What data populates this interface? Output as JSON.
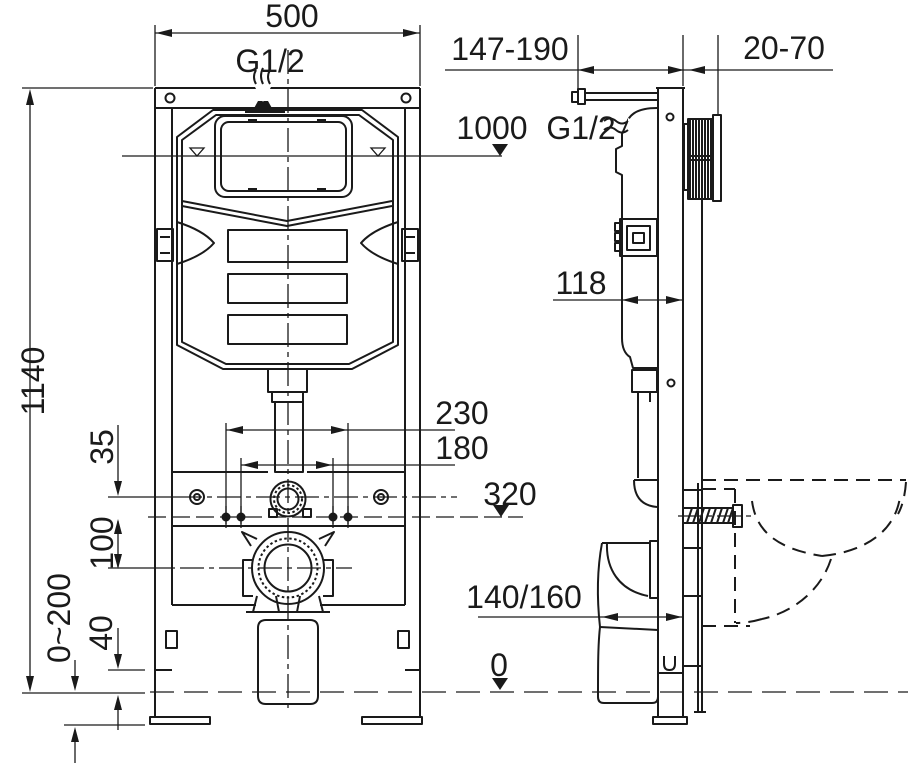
{
  "title": "Concealed WC cistern mounting frame - installation drawing",
  "colors": {
    "line": "#1a1a1a",
    "bg": "#ffffff"
  },
  "front_view": {
    "frame_width": "500",
    "inlet_thread": "G1/2",
    "frame_height": "1140",
    "stud_spacing_outer": "230",
    "stud_spacing_inner": "180",
    "rail_to_holes": "35",
    "holes_to_drain": "100",
    "leg_adjustment_range": "0~200",
    "floor_offset": "40"
  },
  "side_view": {
    "mounting_depth_range": "147-190",
    "finished_wall_range": "20-70",
    "water_level_height": "1000",
    "inlet_thread": "G1/2",
    "cistern_depth": "118",
    "outlet_level_height": "320",
    "drain_pipe_size": "140/160",
    "floor_level": "0"
  }
}
